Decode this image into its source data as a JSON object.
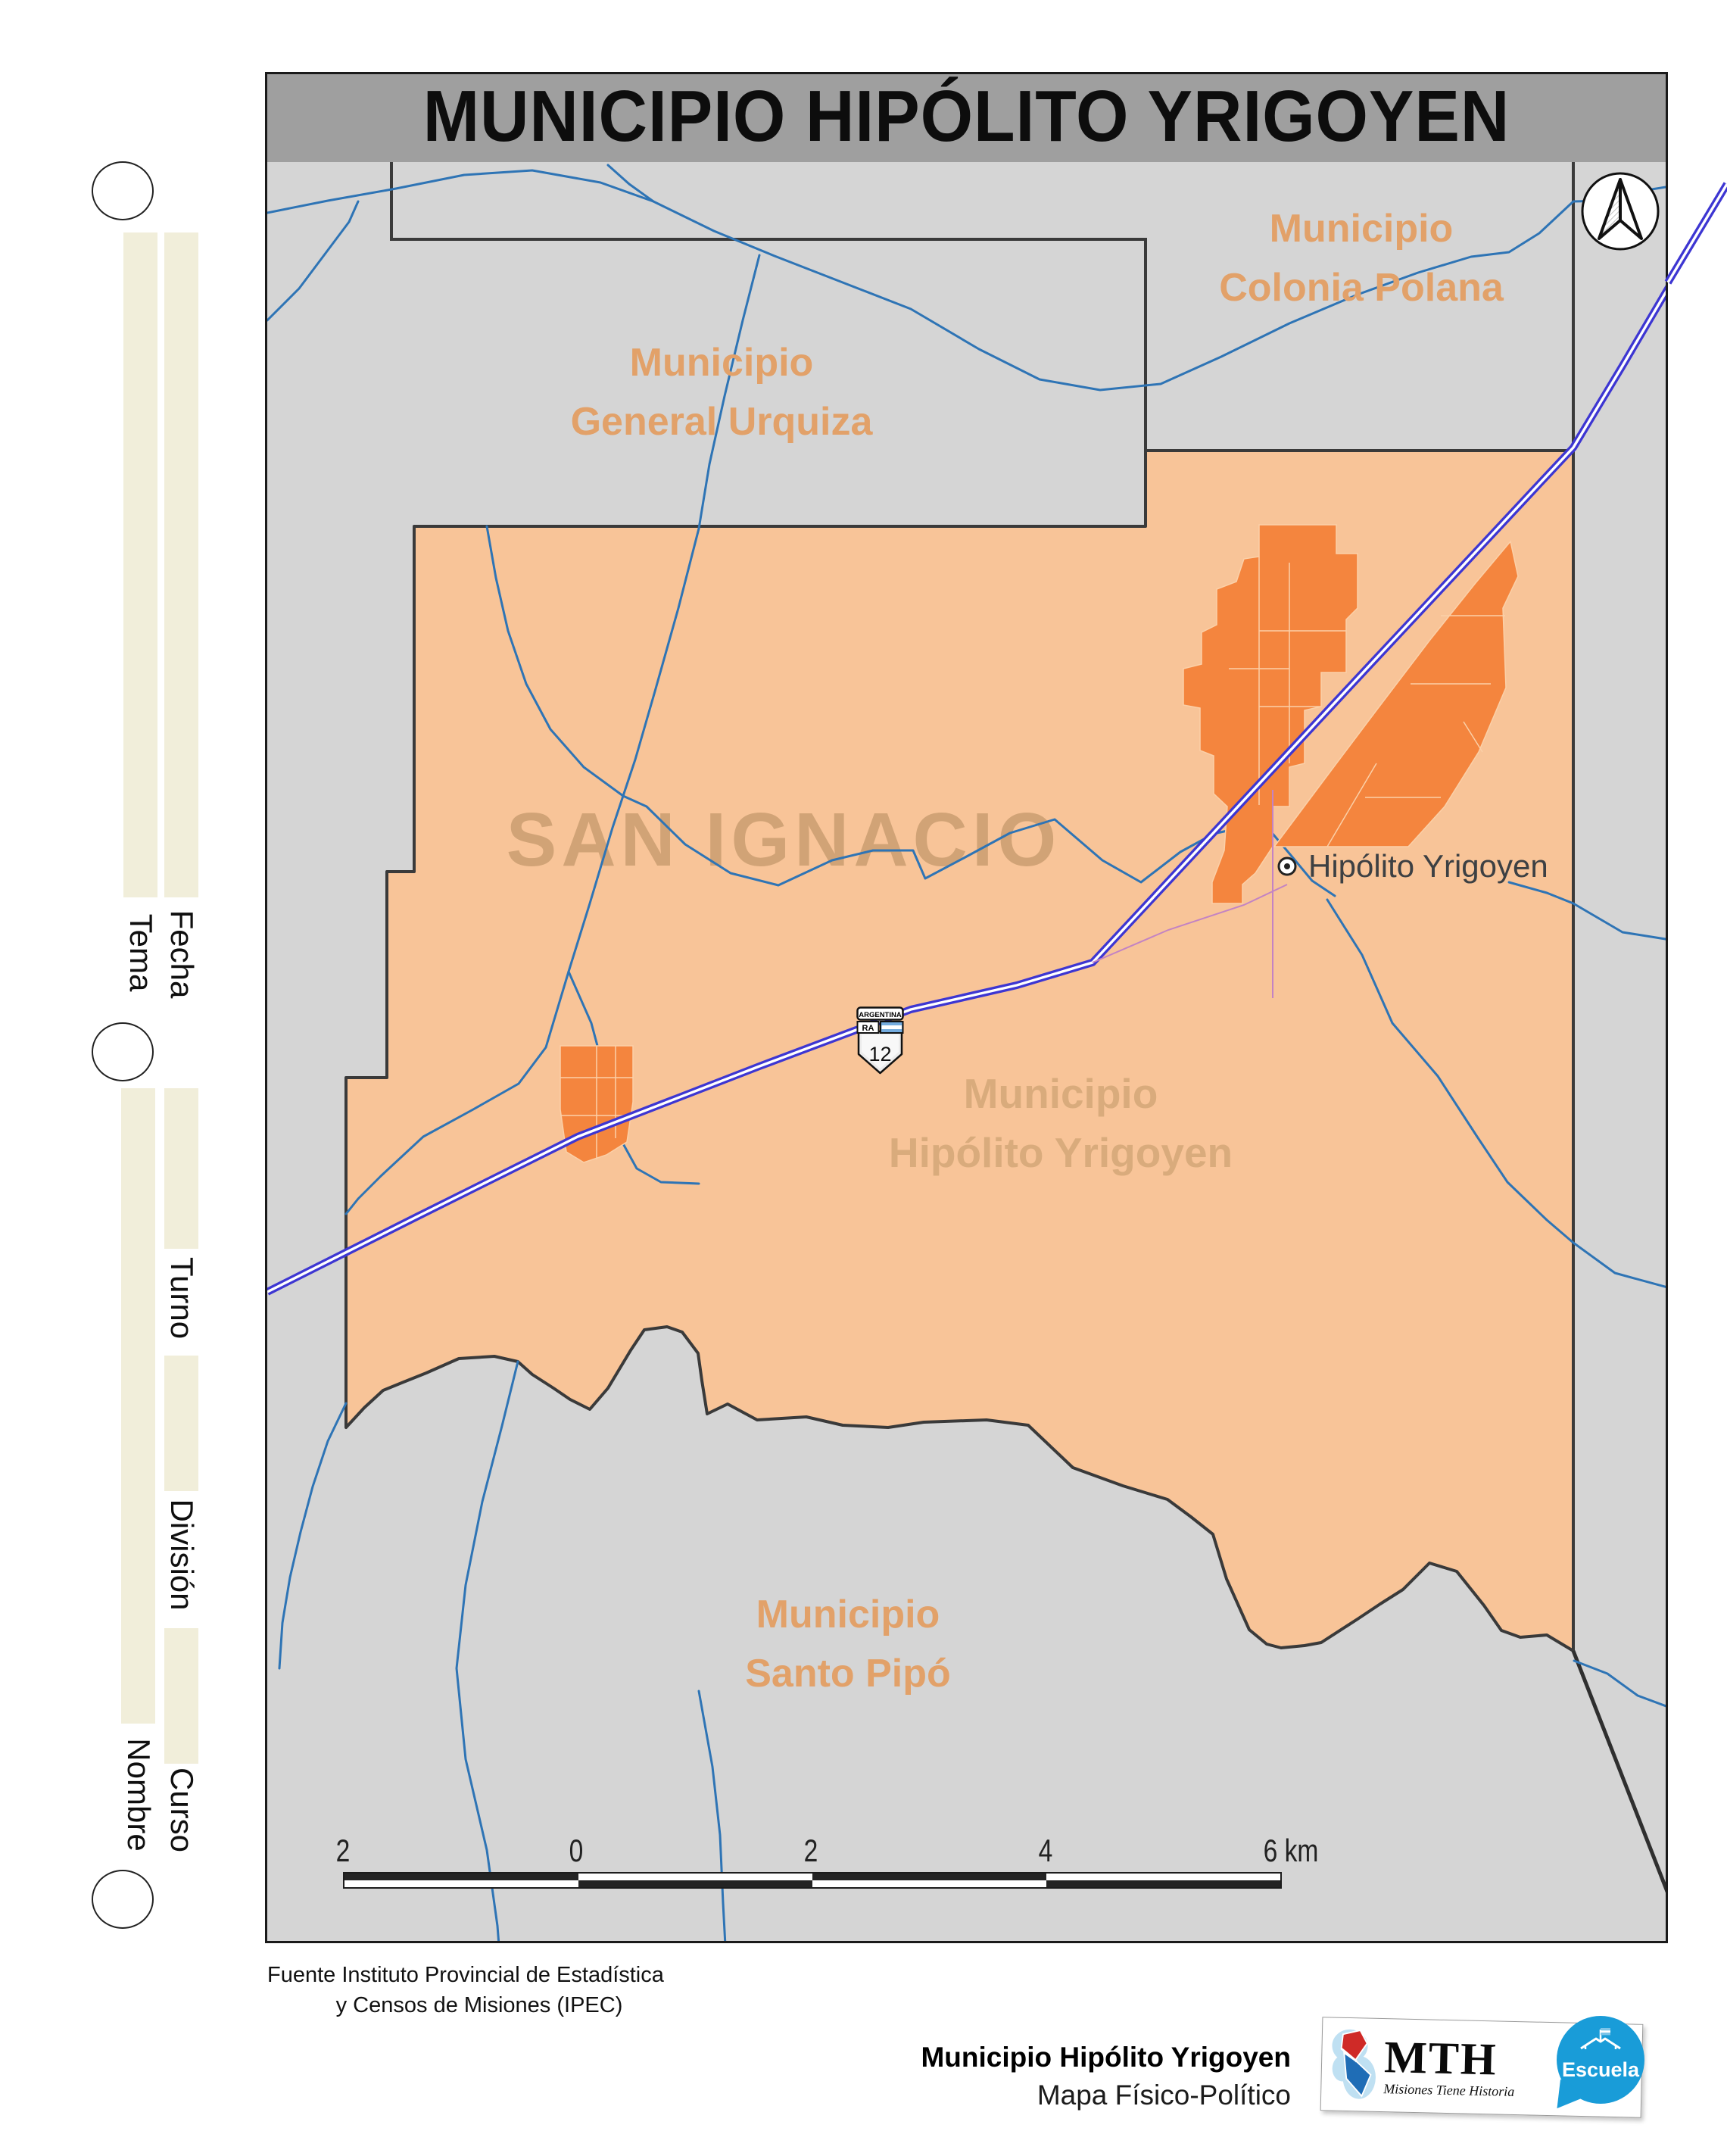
{
  "title": "MUNICIPIO HIPÓLITO YRIGOYEN",
  "department_watermark": "SAN IGNACIO",
  "regions": {
    "general_urquiza": {
      "line1": "Municipio",
      "line2": "General Urquiza"
    },
    "colonia_polana": {
      "line1": "Municipio",
      "line2": "Colonia Polana"
    },
    "hipolito_yrigoyen": {
      "line1": "Municipio",
      "line2": "Hipólito Yrigoyen"
    },
    "santo_pipo": {
      "line1": "Municipio",
      "line2": "Santo Pipó"
    }
  },
  "town": {
    "label": "Hipólito Yrigoyen"
  },
  "route_shield": {
    "country": "ARGENTINA",
    "code": "RA",
    "number": "12"
  },
  "scale_bar": {
    "labels": [
      "2",
      "0",
      "2",
      "4",
      "6 km"
    ]
  },
  "source_note": {
    "line1": "Fuente Instituto Provincial de Estadística",
    "line2": "y Censos de Misiones (IPEC)"
  },
  "footer": {
    "map_name": "Municipio Hipólito Yrigoyen",
    "map_type": "Mapa Físico-Político",
    "mth_acronym": "MTH",
    "mth_tagline": "Misiones Tiene Historia",
    "escuela_label": "Escuela"
  },
  "worksheet_fields": {
    "tema": "Tema",
    "fecha": "Fecha",
    "turno": "Turno",
    "division": "División",
    "nombre": "Nombre",
    "curso": "Curso"
  },
  "colors": {
    "municipality_fill": "#f8c498",
    "urban_fill": "#f4853e",
    "neighbor_fill": "#d5d5d5",
    "boundary": "#3a3a3a",
    "river": "#2e74b5",
    "route": "#3d36d2",
    "label_orange": "#e2a169",
    "watermark": "#c89b6e",
    "title_band": "#9f9f9f",
    "worksheet_bar": "#f1eeda",
    "escuela_blue": "#199cd8"
  }
}
